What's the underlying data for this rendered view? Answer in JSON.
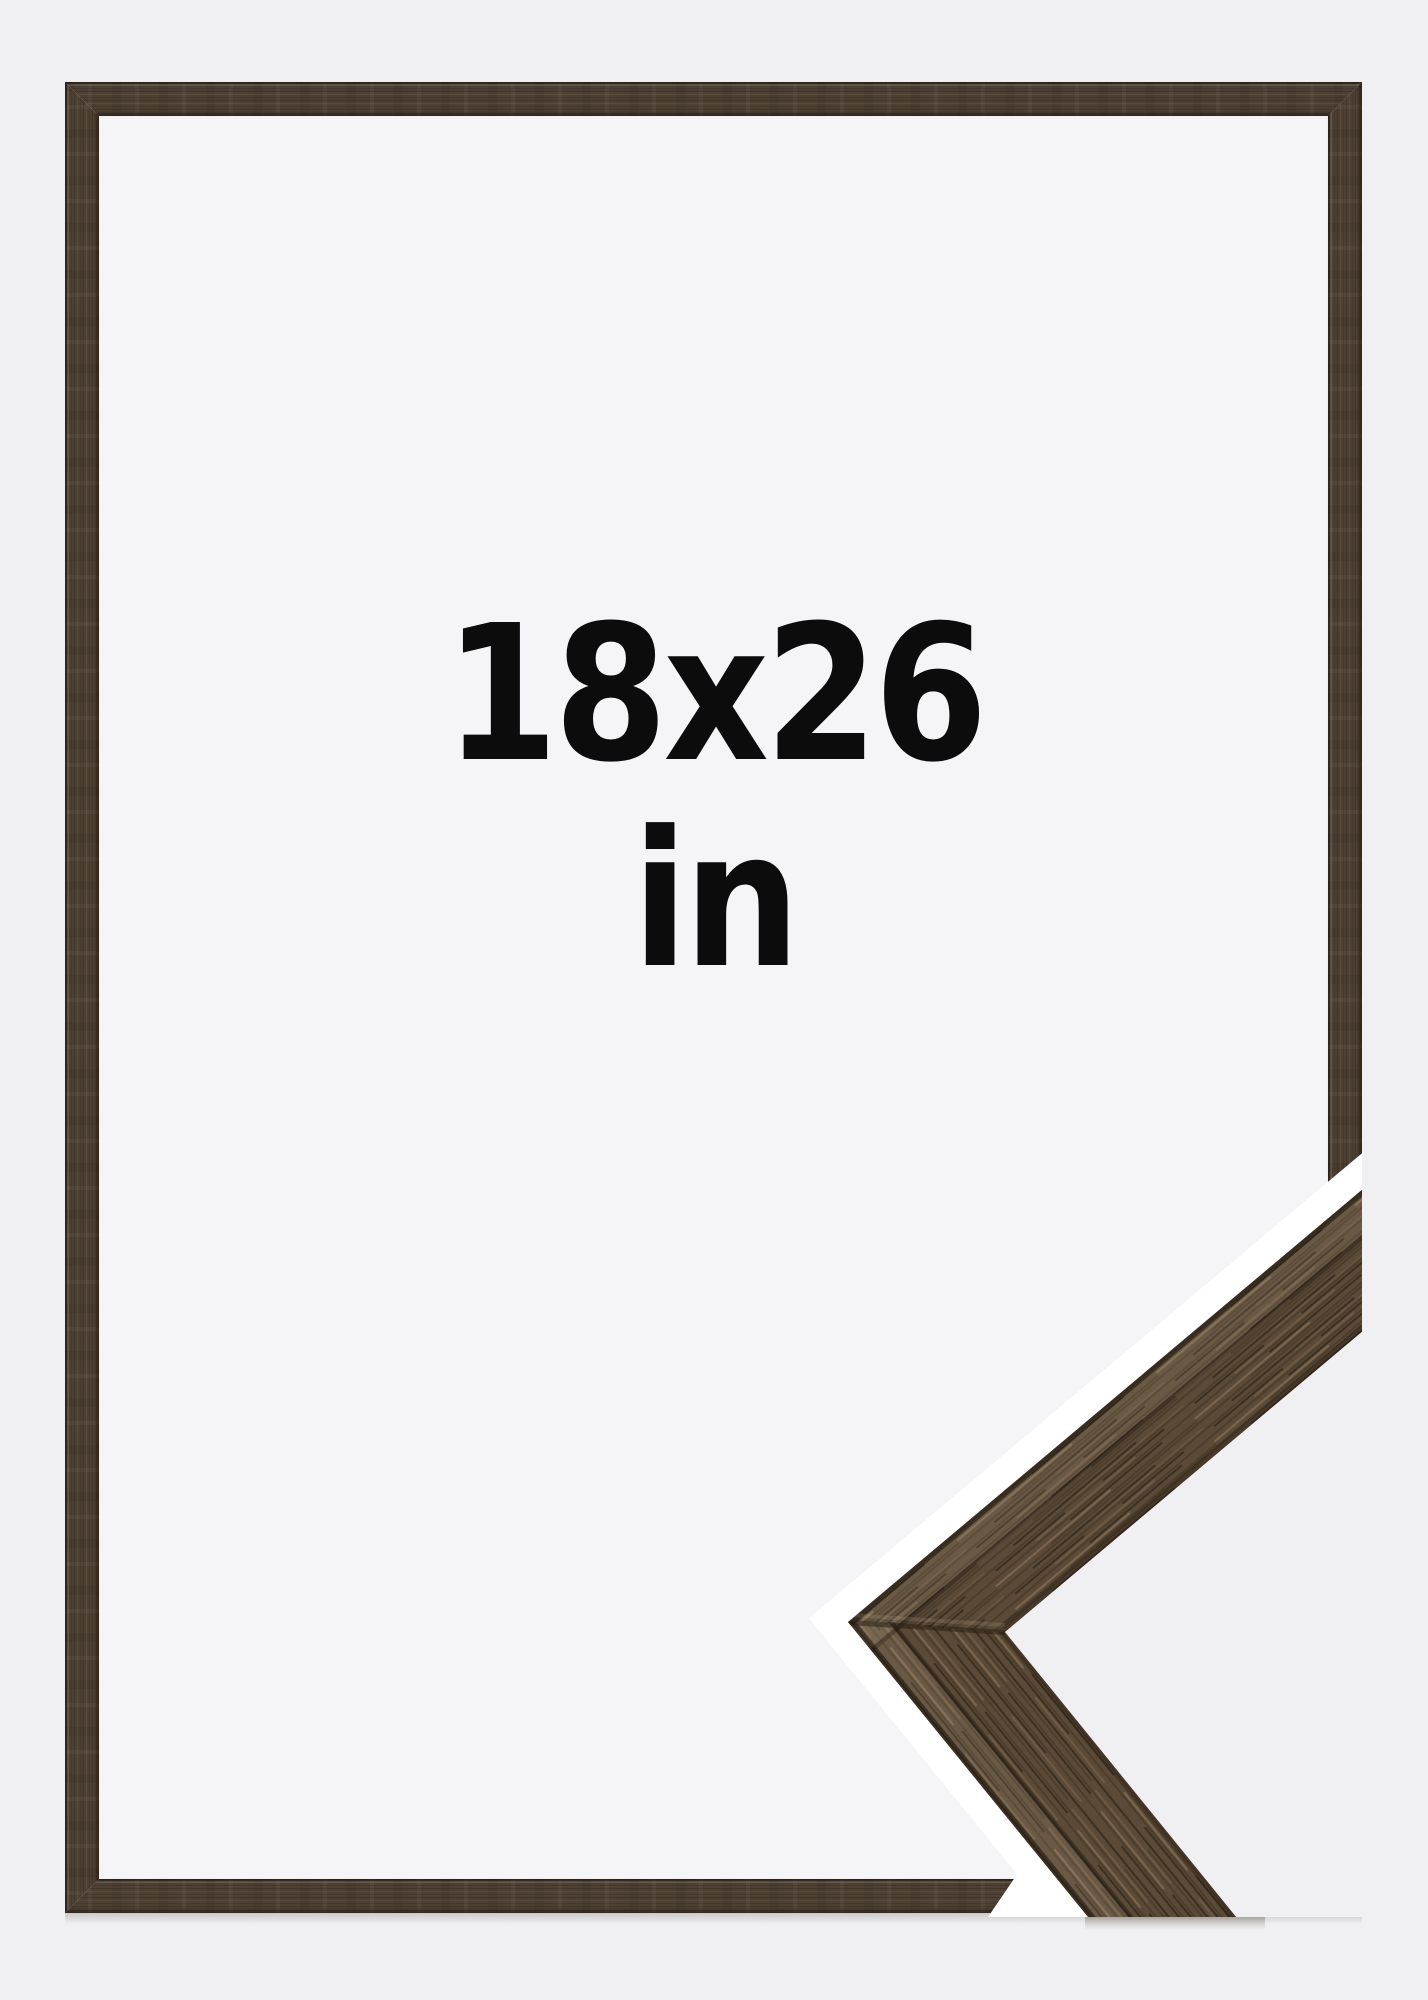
{
  "frame": {
    "size_label": "18x26",
    "unit_label": "in"
  },
  "colors": {
    "page_bg": "#f0f0f2",
    "interior_bg": "#f5f5f7",
    "halo": "#ffffff",
    "text": "#0c0c0c",
    "wood_frame": "#4d4033",
    "wood_base": "#5a4a37",
    "wood_mid": "#4c3d2c",
    "wood_dark": "#3b2f22",
    "wood_light": "#6f5a44",
    "wood_lighter": "#7c6650",
    "wood_edge": "#241b12"
  }
}
